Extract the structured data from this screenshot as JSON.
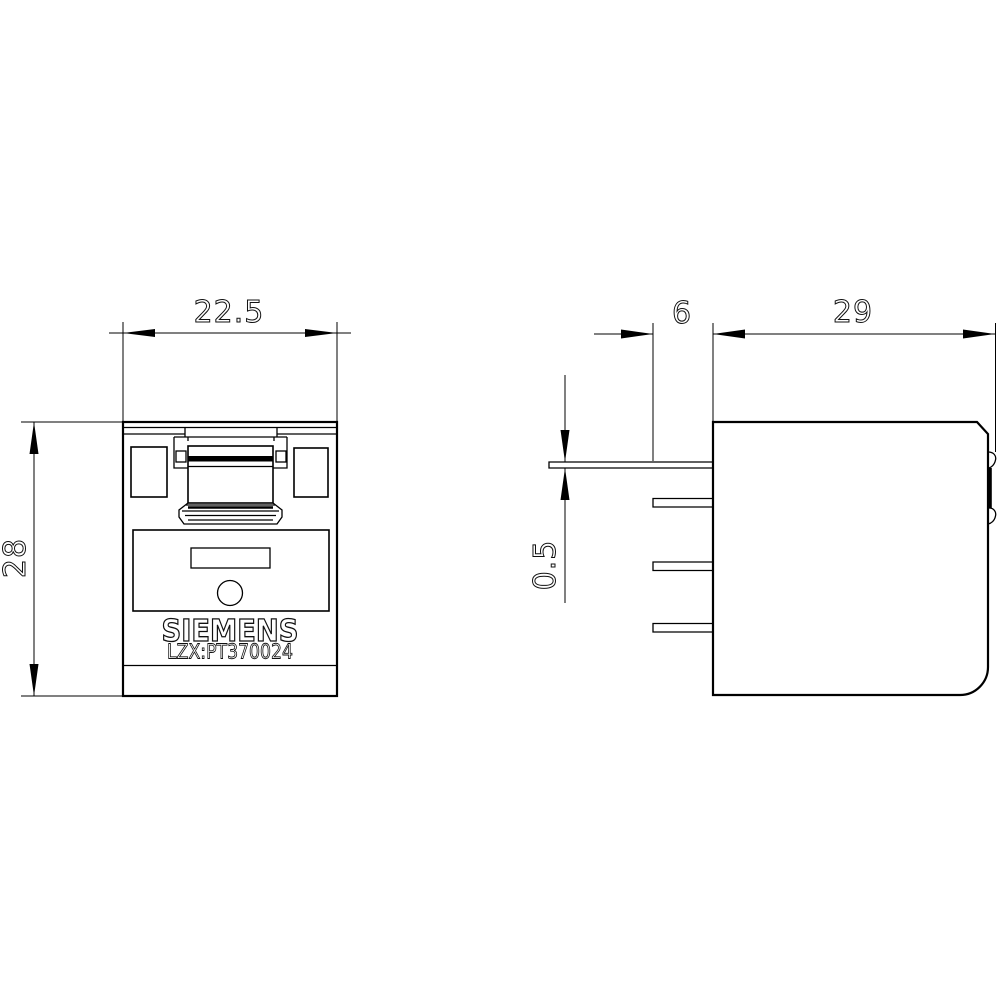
{
  "brand": "SIEMENS",
  "part_number": "LZX:PT370024",
  "dimensions": {
    "width": "22.5",
    "height": "28",
    "pin_offset": "6",
    "depth": "29",
    "pin_thickness": "0.5"
  },
  "colors": {
    "line": "#000000",
    "background": "#ffffff"
  }
}
